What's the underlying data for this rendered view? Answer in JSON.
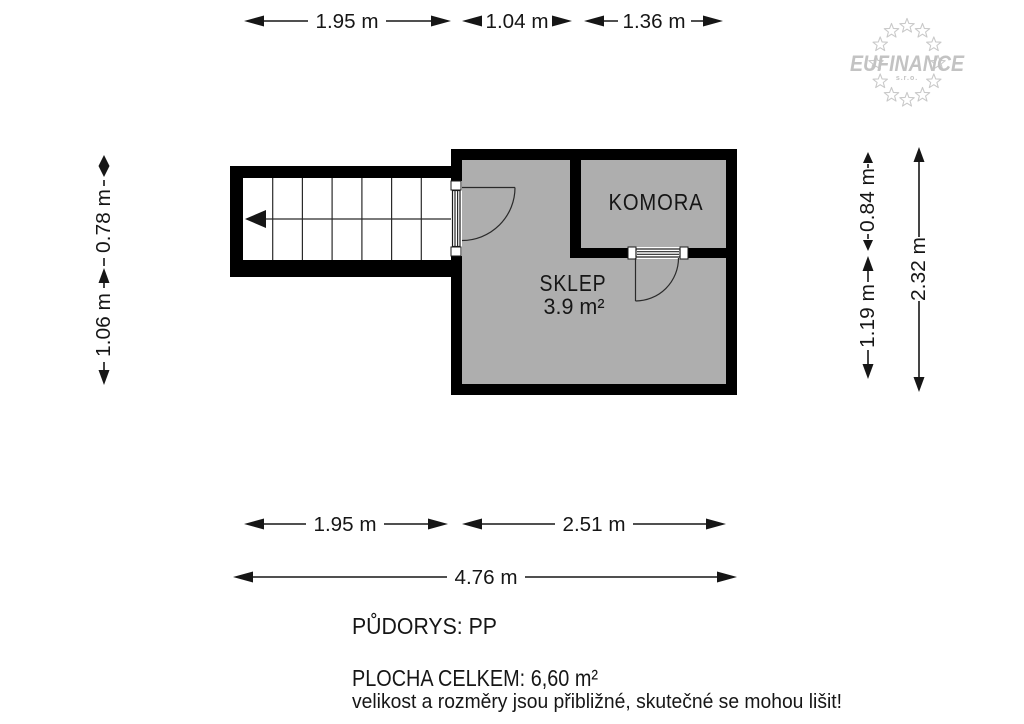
{
  "logo": {
    "name": "EUFINANCE",
    "suffix": "s.r.o."
  },
  "rooms": {
    "sklep": {
      "label": "SKLEP",
      "area": "3.9 m²"
    },
    "komora": {
      "label": "KOMORA"
    }
  },
  "dimensions": {
    "top": [
      "1.95 m",
      "1.04 m",
      "1.36 m"
    ],
    "left": [
      "0.78 m",
      "1.06 m"
    ],
    "right": [
      "0.84 m",
      "1.19 m"
    ],
    "right_total": "2.32 m",
    "bottom": [
      "1.95 m",
      "2.51 m"
    ],
    "bottom_total": "4.76 m"
  },
  "footer": {
    "floor": "PŮDORYS: PP",
    "area_total": "PLOCHA CELKEM: 6,60  m²",
    "disclaimer": "velikost a rozměry jsou přibližné, skutečné se mohou lišit!"
  },
  "colors": {
    "wall": "#000000",
    "room_fill": "#aeaeae",
    "line": "#161616",
    "logo_gray": "#c3c3c3"
  }
}
